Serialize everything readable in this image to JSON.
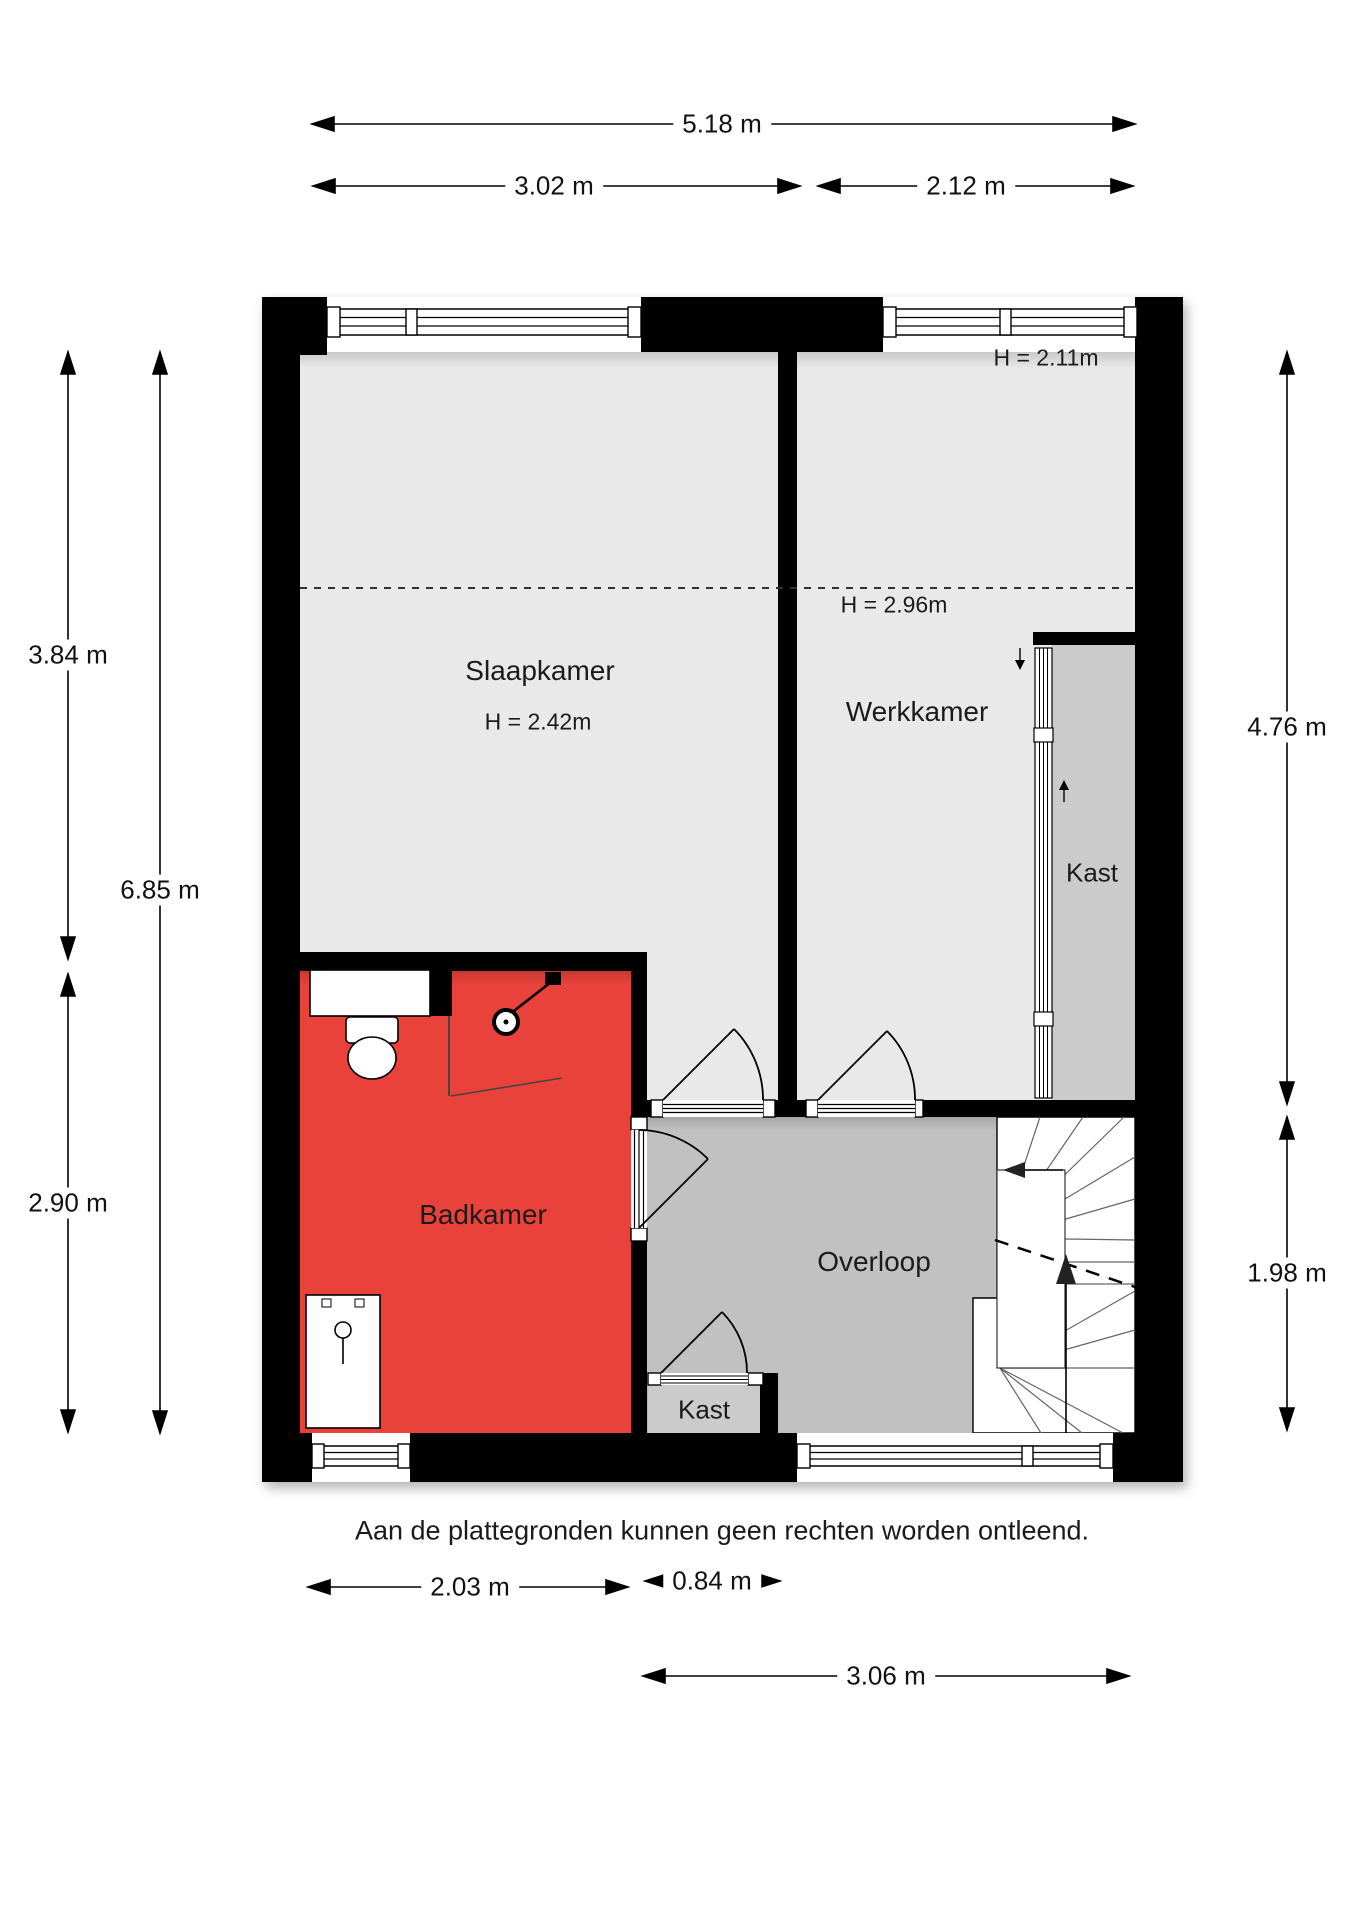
{
  "rooms": {
    "slaapkamer": {
      "label": "Slaapkamer",
      "height": "H = 2.42m"
    },
    "werkkamer": {
      "label": "Werkkamer",
      "height": "H = 2.96m",
      "height_top": "H = 2.11m"
    },
    "badkamer": {
      "label": "Badkamer"
    },
    "overloop": {
      "label": "Overloop"
    },
    "kast_right": {
      "label": "Kast"
    },
    "kast_bottom": {
      "label": "Kast"
    }
  },
  "dimensions": {
    "width_total": "5.18 m",
    "width_left": "3.02 m",
    "width_right": "2.12 m",
    "left_upper": "3.84 m",
    "left_total": "6.85 m",
    "left_lower": "2.90 m",
    "right_upper": "4.76 m",
    "right_lower": "1.98 m",
    "bottom_badkamer": "2.03 m",
    "bottom_kast": "0.84 m",
    "bottom_right": "3.06 m"
  },
  "footer": "Aan de plattegronden kunnen geen rechten worden ontleend.",
  "colors": {
    "bathroom_red": "#e8423a",
    "floor_light": "#e9e9e9",
    "floor_closet": "#cbcbcb",
    "floor_overloop": "#c1c1c1",
    "wall": "#000000"
  }
}
